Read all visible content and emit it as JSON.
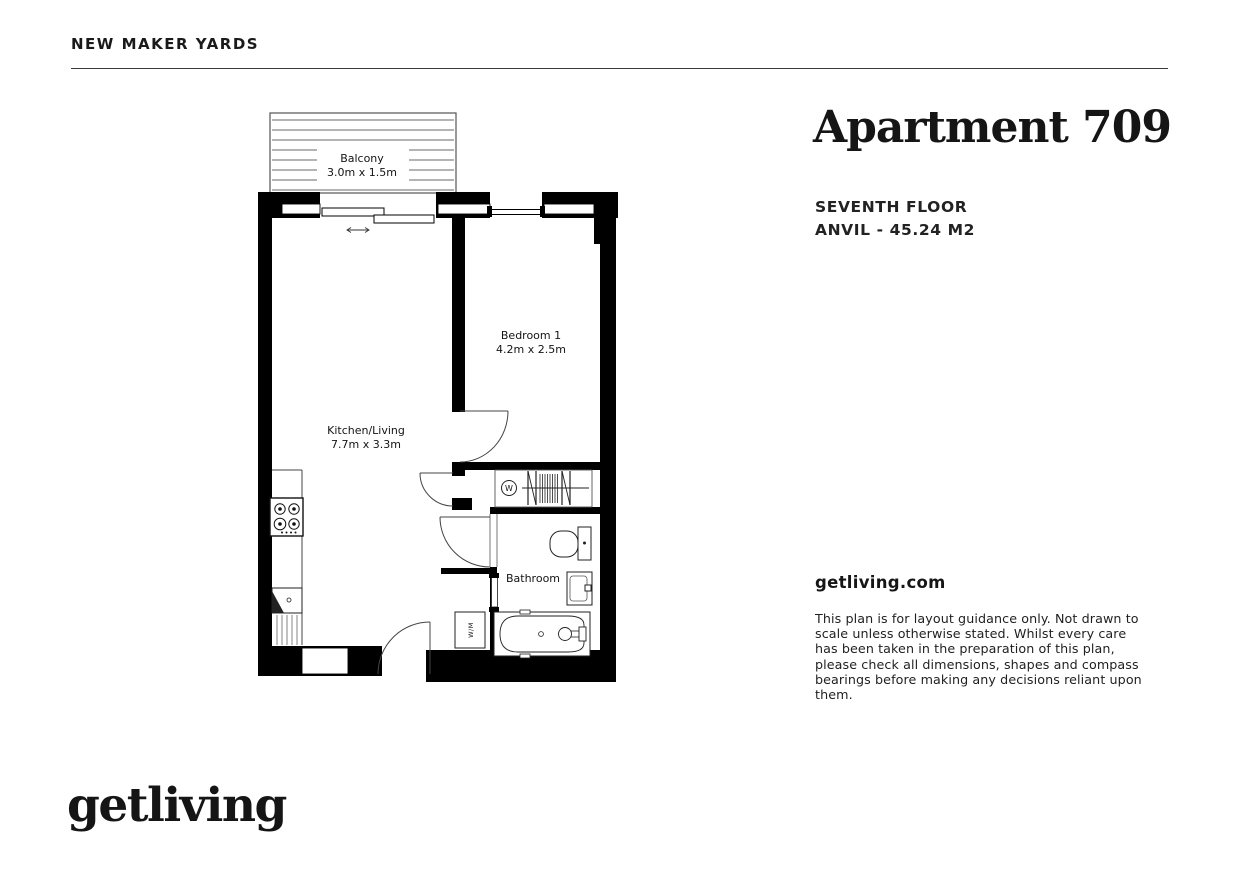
{
  "header": {
    "development_name": "NEW MAKER YARDS"
  },
  "apartment": {
    "title": "Apartment 709",
    "floor": "SEVENTH FLOOR",
    "block_area": "ANVIL - 45.24 M2"
  },
  "floor_plan": {
    "rooms": [
      {
        "name": "Balcony",
        "dimensions": "3.0m x 1.5m"
      },
      {
        "name": "Bedroom 1",
        "dimensions": "4.2m x 2.5m"
      },
      {
        "name": "Kitchen/Living",
        "dimensions": "7.7m x 3.3m"
      },
      {
        "name": "Bathroom",
        "dimensions": ""
      }
    ],
    "annotations": {
      "washer_symbol": "W",
      "washing_machine": "W/M"
    }
  },
  "footer": {
    "website": "getliving.com",
    "logo": "getliving",
    "disclaimer": "This plan is for layout guidance only. Not drawn to scale unless otherwise stated. Whilst every care has been taken in the preparation of this plan, please check all dimensions, shapes and compass bearings before making any decisions reliant upon them."
  },
  "colors": {
    "ink": "#1a1a1a",
    "wall": "#000000",
    "line": "#4a4a4a"
  }
}
